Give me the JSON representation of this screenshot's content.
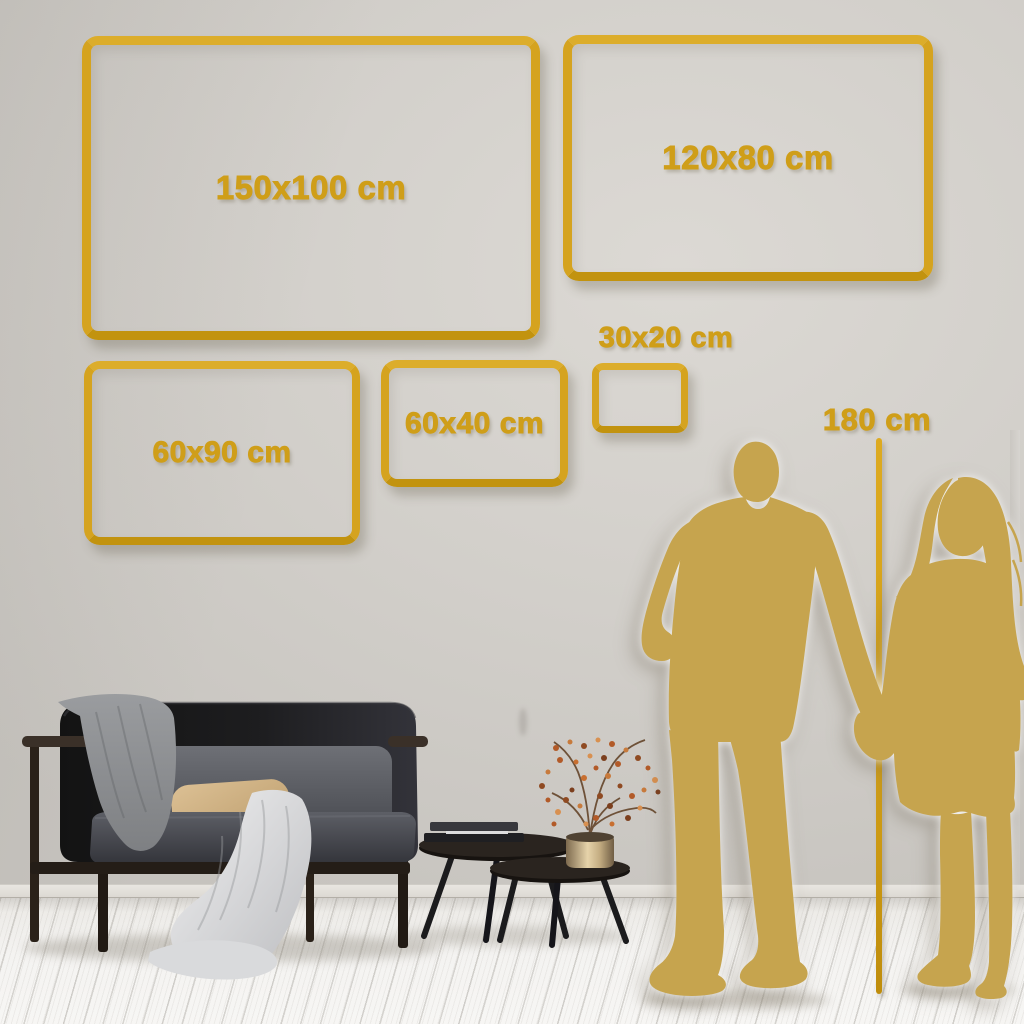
{
  "title": "Wall art canvas size comparison guide",
  "palette": {
    "accent_gold": "#d2a01d",
    "silhouette_gold": "#c6a44e",
    "wall": "#d2cfca",
    "floor": "#f0efec"
  },
  "size_frames": [
    {
      "id": "150x100",
      "label": "150x100 cm"
    },
    {
      "id": "120x80",
      "label": "120x80 cm"
    },
    {
      "id": "60x90",
      "label": "60x90 cm"
    },
    {
      "id": "60x40",
      "label": "60x40 cm"
    },
    {
      "id": "30x20",
      "label": "30x20 cm"
    }
  ],
  "height_reference": {
    "label": "180 cm"
  },
  "scene": {
    "objects": [
      "dark-velvet-sofa",
      "gray-throw-blanket",
      "beige-pillow",
      "nesting-coffee-tables",
      "books",
      "brass-vase-with-dried-branch",
      "couple-silhouette",
      "height-ruler-line"
    ]
  }
}
